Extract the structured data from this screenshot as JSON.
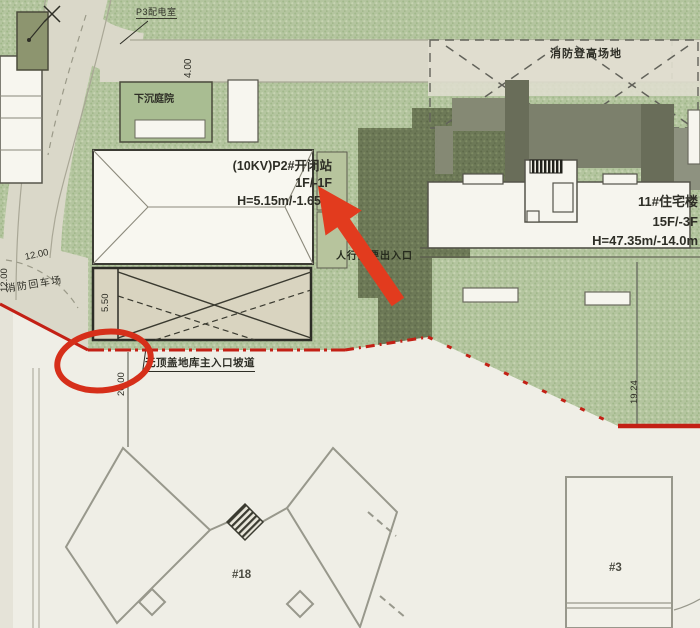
{
  "plan": {
    "labels": {
      "p3_room": "P3配电室",
      "sunken_courtyard": "下沉庭院",
      "fire_access_area": "消防登高场地",
      "fire_turnaround": "消防回车场",
      "pedestrian_entrance": "人行主要出入口",
      "ramp_note": "无顶盖地库主入口坡道"
    },
    "buildings": {
      "kv_station": {
        "name": "(10KV)P2#开闭站",
        "floors": "1F/-1F",
        "height": "H=5.15m/-1.65m"
      },
      "residential_11": {
        "name": "11#住宅楼",
        "floors": "15F/-3F",
        "height": "H=47.35m/-14.0m"
      },
      "building_18": "#18",
      "building_3": "#3"
    },
    "dimensions": {
      "road_width": "4.00",
      "turnaround_width": "12.00",
      "edge_width": "12.00",
      "ramp_width": "5.50",
      "boundary_setback": "20.00",
      "east_setback": "19.24"
    },
    "colors": {
      "markup_red": "#e23b1e",
      "circle_red": "#d62f1a",
      "boundary_red": "#c32015",
      "landscape_green": "#b4c59f",
      "tree_dark_green": "#6d7957",
      "road_beige": "#dad8c9"
    }
  }
}
